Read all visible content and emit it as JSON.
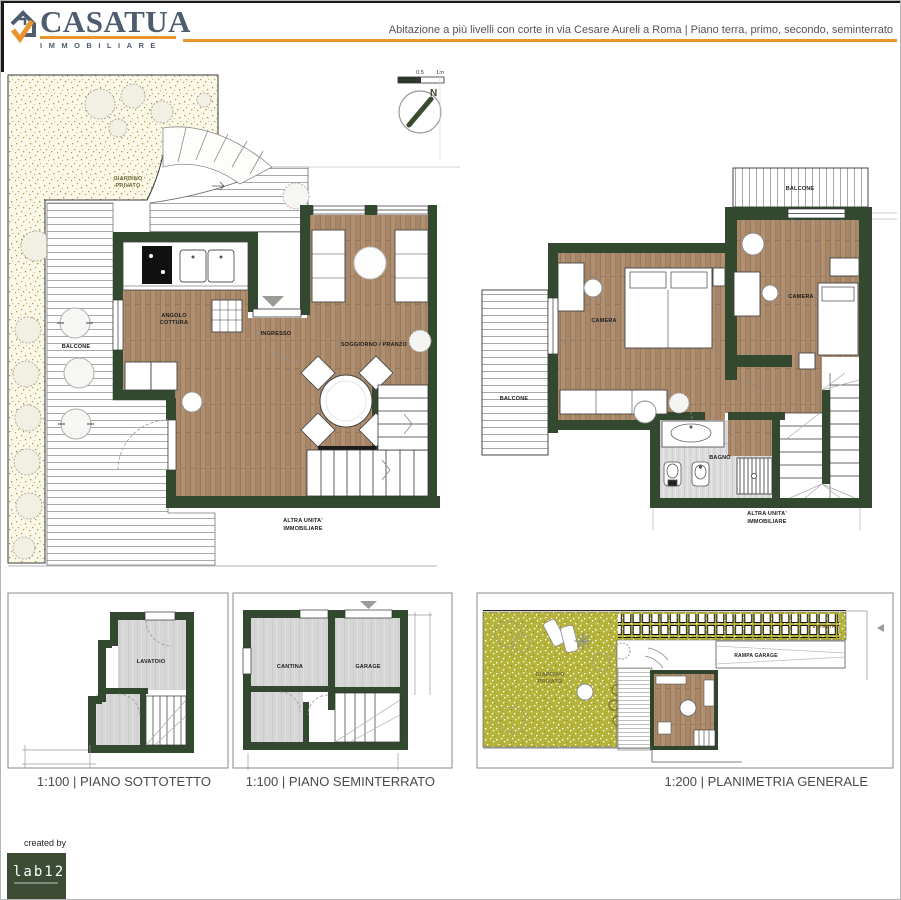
{
  "header": {
    "brand_name": "CASATUA",
    "brand_sub": "IMMOBILIARE",
    "title": "Abitazione a più livelli con corte in via Cesare Aureli a Roma | Piano terra, primo, secondo, seminterrato"
  },
  "compass": {
    "north": "N",
    "scale_left": "0.5",
    "scale_right": "1m"
  },
  "plans": {
    "ground": {
      "giardino_l1": "GIARDINO",
      "giardino_l2": "PRIVATO",
      "balcone": "BALCONE",
      "angolo_l1": "ANGOLO",
      "angolo_l2": "COTTURA",
      "ingresso": "INGRESSO",
      "soggiorno": "SOGGIORNO / PRANZO",
      "altra_l1": "ALTRA UNITA'",
      "altra_l2": "IMMOBILIARE"
    },
    "first": {
      "balcone_top": "BALCONE",
      "balcone_left": "BALCONE",
      "camera_left": "CAMERA",
      "camera_right": "CAMERA",
      "bagno": "BAGNO",
      "altra_l1": "ALTRA UNITA'",
      "altra_l2": "IMMOBILIARE"
    },
    "sottotetto": {
      "lavatoio": "LAVATOIO",
      "caption": "1:100 | PIANO SOTTOTETTO"
    },
    "seminterrato": {
      "cantina": "CANTINA",
      "garage": "GARAGE",
      "caption": "1:100 | PIANO SEMINTERRATO"
    },
    "generale": {
      "giardino_l1": "GIARDINO",
      "giardino_l2": "PRIVATO",
      "rampa": "RAMPA GARAGE",
      "entrata": "ENTRATA",
      "caption": "1:200 | PLANIMETRIA GENERALE"
    }
  },
  "footer": {
    "created_by": "created by",
    "lab": "lab12"
  },
  "colors": {
    "accent_orange": "#E8952E",
    "brand_slate": "#4E5C70",
    "wall_green": "#33492F",
    "wood_brown": "#B1906F",
    "olive_green": "#B6B33A",
    "garden_cream": "#FBF8E8"
  }
}
